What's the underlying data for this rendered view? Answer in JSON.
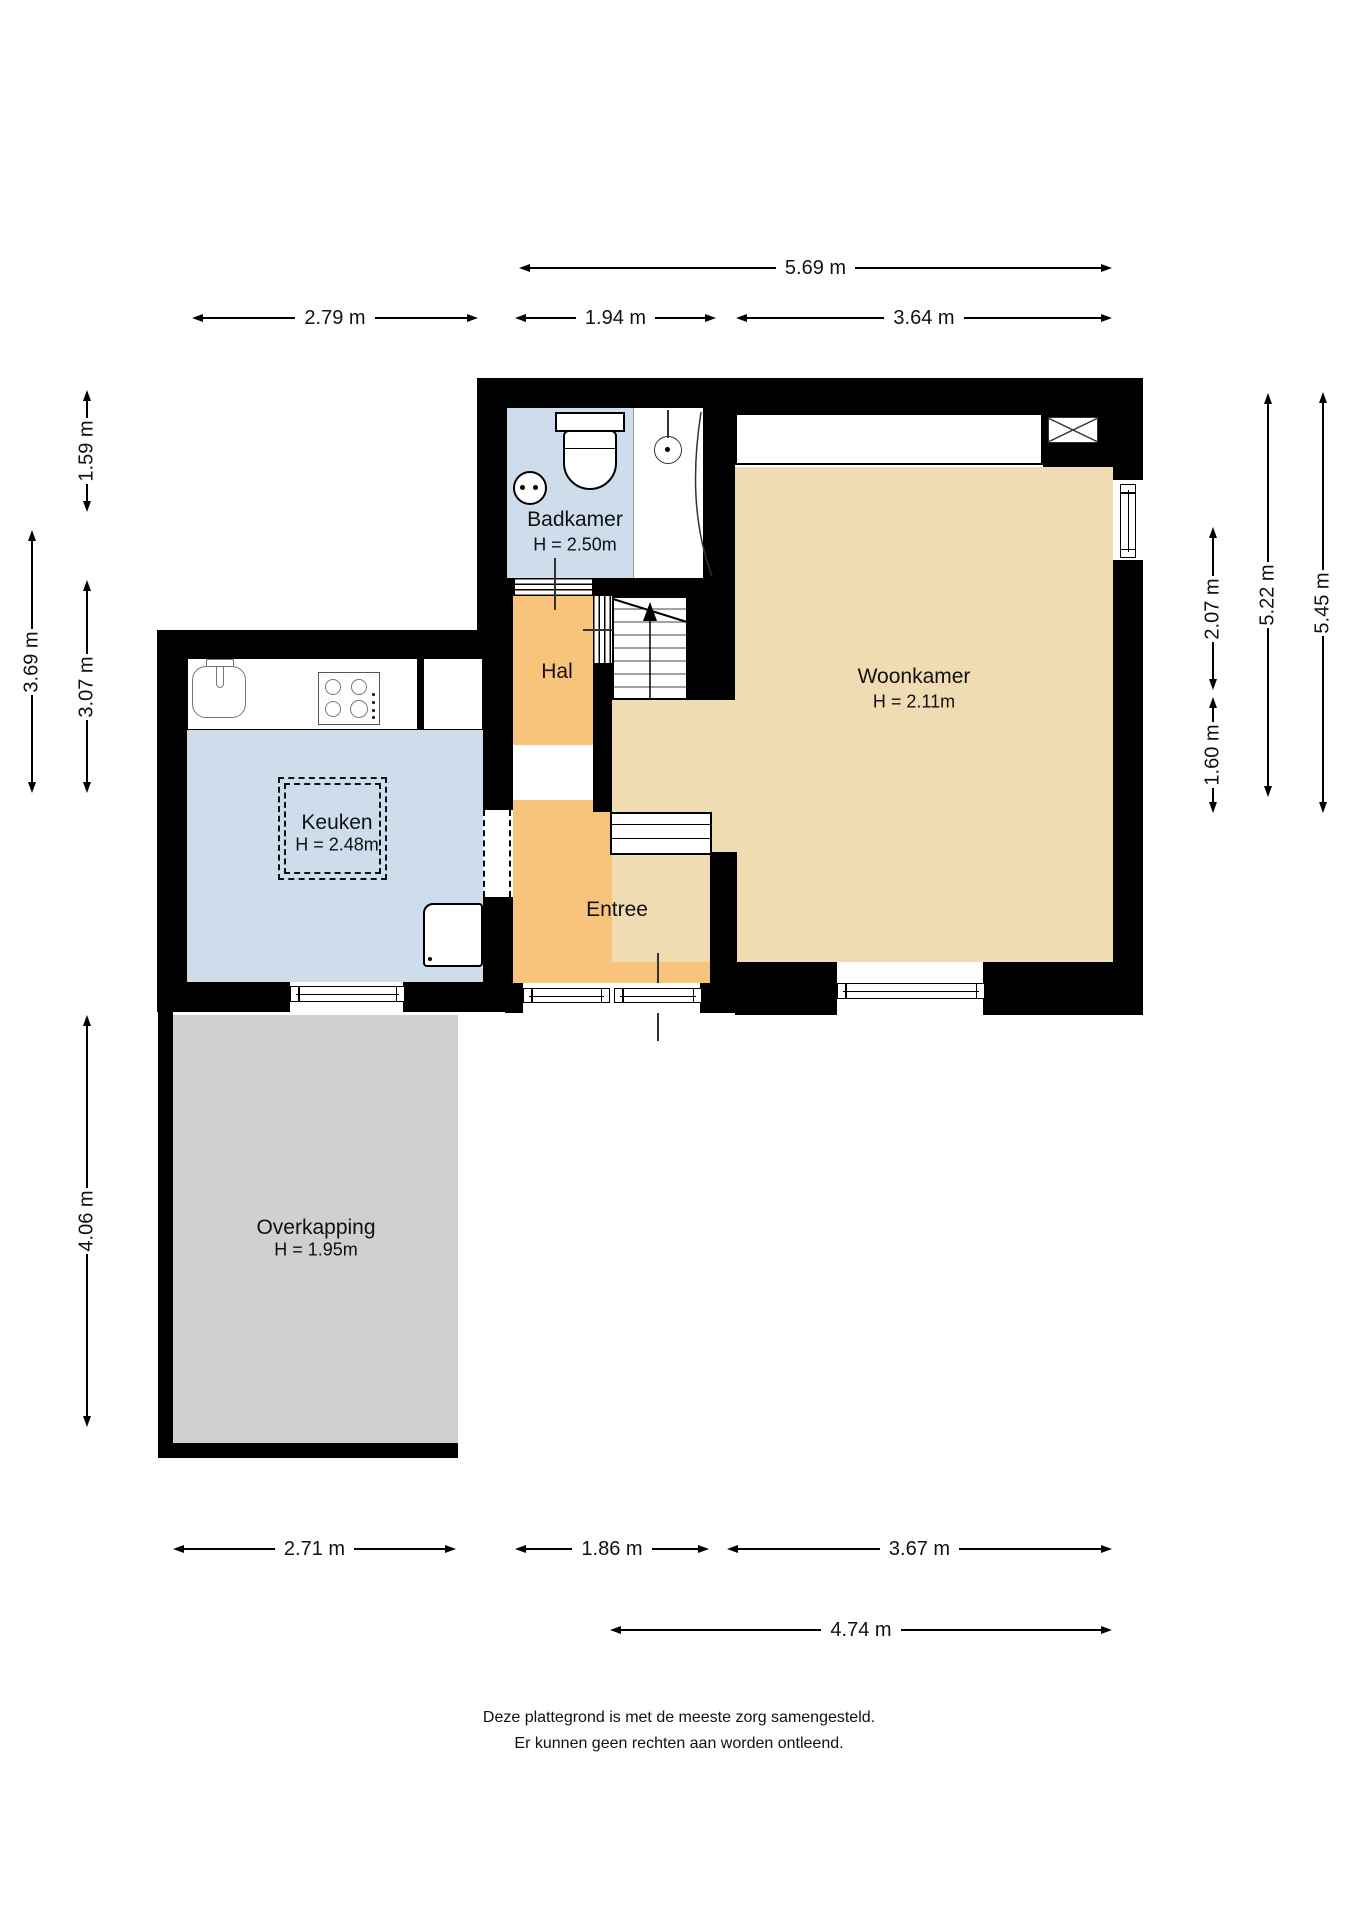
{
  "colors": {
    "wall": "#000000",
    "wet": "#cdddec",
    "hall": "#f8c47b",
    "living": "#f0dcb2",
    "outside": "#d0d0d0",
    "line": "#000000",
    "fix": "#777777"
  },
  "rooms": {
    "badkamer": {
      "name": "Badkamer",
      "height": "H = 2.50m"
    },
    "hal": {
      "name": "Hal"
    },
    "woonkamer": {
      "name": "Woonkamer",
      "height": "H = 2.11m"
    },
    "keuken": {
      "name": "Keuken",
      "height": "H = 2.48m"
    },
    "entree": {
      "name": "Entree"
    },
    "overkapping": {
      "name": "Overkapping",
      "height": "H = 1.95m"
    }
  },
  "dimensions": {
    "top": [
      {
        "label": "5.69 m"
      },
      {
        "label": "2.79 m"
      },
      {
        "label": "1.94 m"
      },
      {
        "label": "3.64 m"
      }
    ],
    "left": [
      {
        "label": "1.59 m"
      },
      {
        "label": "3.69 m"
      },
      {
        "label": "3.07 m"
      },
      {
        "label": "4.06 m"
      }
    ],
    "right": [
      {
        "label": "2.07 m"
      },
      {
        "label": "1.60 m"
      },
      {
        "label": "5.22 m"
      },
      {
        "label": "5.45 m"
      }
    ],
    "bottom": [
      {
        "label": "2.71 m"
      },
      {
        "label": "1.86 m"
      },
      {
        "label": "3.67 m"
      },
      {
        "label": "4.74 m"
      }
    ]
  },
  "disclaimer": {
    "line1": "Deze plattegrond is met de meeste zorg samengesteld.",
    "line2": "Er kunnen geen rechten aan worden ontleend."
  }
}
